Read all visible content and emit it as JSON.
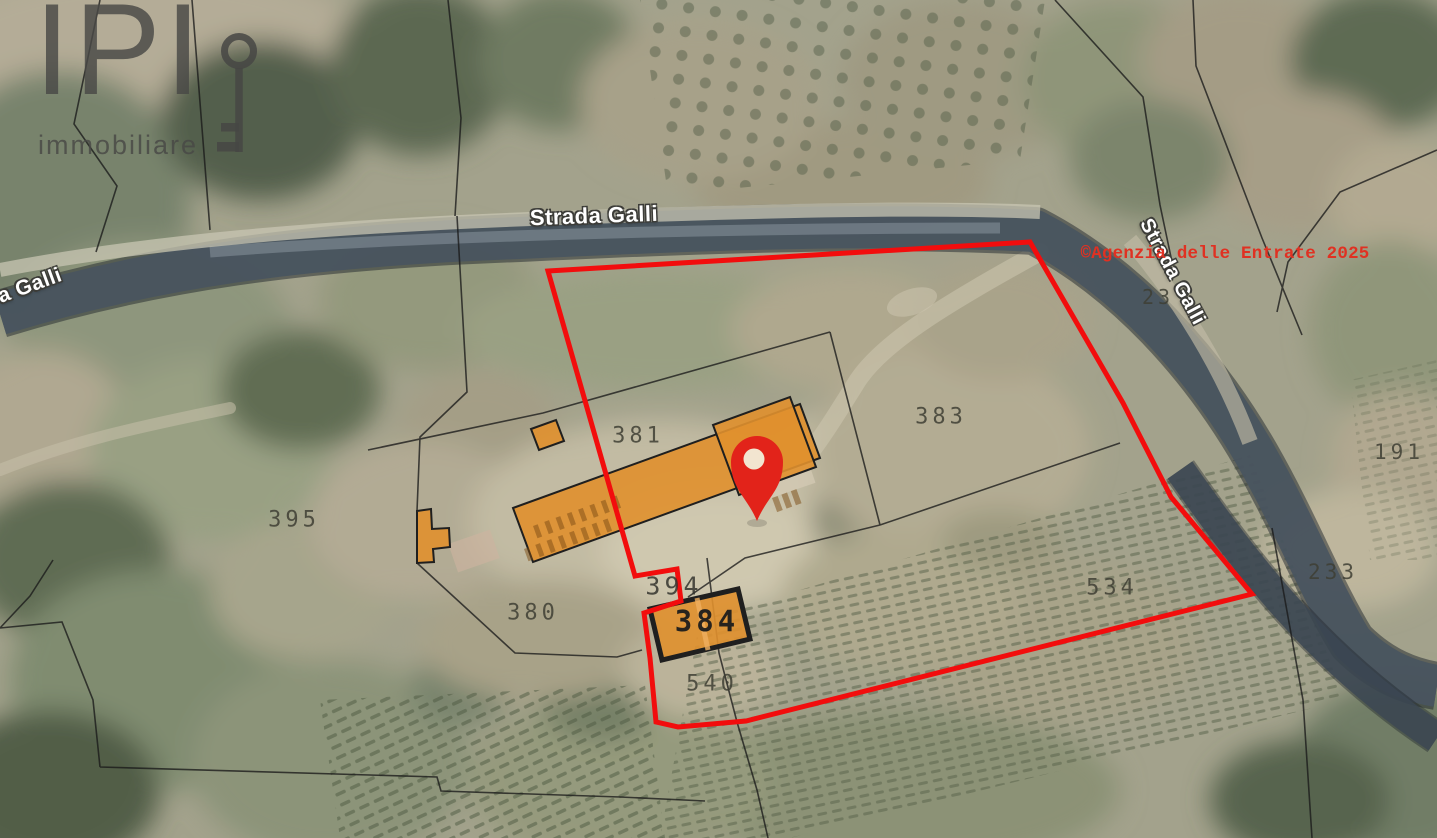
{
  "branding": {
    "logo_text": "IPI",
    "logo_subtitle": "immobiliare"
  },
  "attribution": {
    "copyright": "©Agenzia delle Entrate 2025"
  },
  "road_labels": {
    "top": "Strada Galli",
    "left_partial": "a Galli",
    "right": "Strada Galli"
  },
  "parcels": [
    {
      "label": "381"
    },
    {
      "label": "383"
    },
    {
      "label": "395"
    },
    {
      "label": "380"
    },
    {
      "label": "394"
    },
    {
      "label": "384"
    },
    {
      "label": "540"
    },
    {
      "label": "534"
    },
    {
      "label": "233"
    },
    {
      "label": "191"
    },
    {
      "label": "23"
    }
  ],
  "overlay": {
    "boundary_color": "#f20d0d",
    "building_fill": "#e0902e",
    "marker_color": "#e2231a",
    "marker_hole_color": "#f2e5d0",
    "parcel_label_color": "#3e3e34",
    "copyright_color": "#e03122",
    "logo_color": "#4a4a48",
    "road_band_color": "#49555f"
  }
}
